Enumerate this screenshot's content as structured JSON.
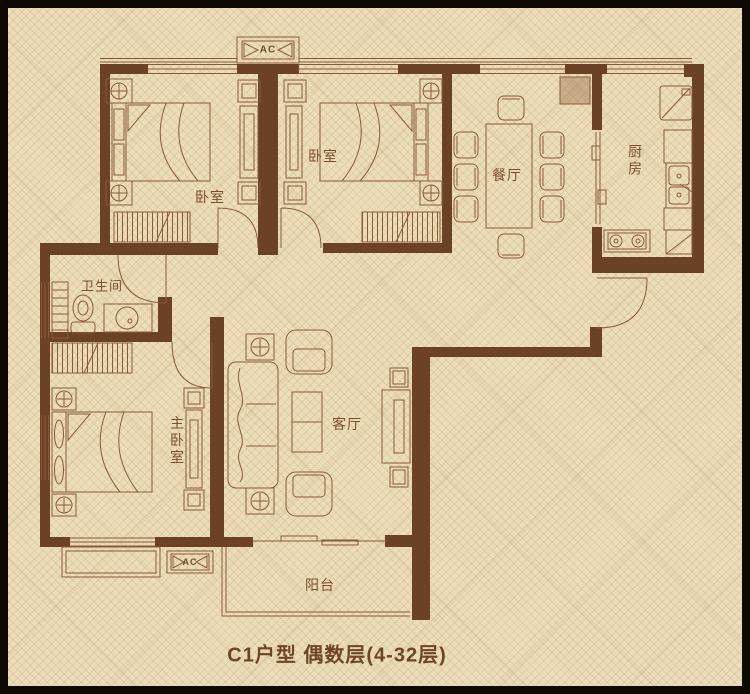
{
  "plan": {
    "caption": "C1户型 偶数层(4-32层)",
    "rooms": {
      "bedroom1": "卧室",
      "bedroom2": "卧室",
      "dining": "餐厅",
      "kitchen": "厨房",
      "bathroom": "卫生间",
      "master": "主卧室",
      "living": "客厅",
      "balcony": "阳台"
    },
    "ac_top": "AC",
    "ac_bottom": "AC",
    "colors": {
      "frame": "#0e0903",
      "background": "#ecddb9",
      "wall": "#6b4226",
      "line": "#8a5a3a",
      "label": "#7b4e2e"
    }
  }
}
